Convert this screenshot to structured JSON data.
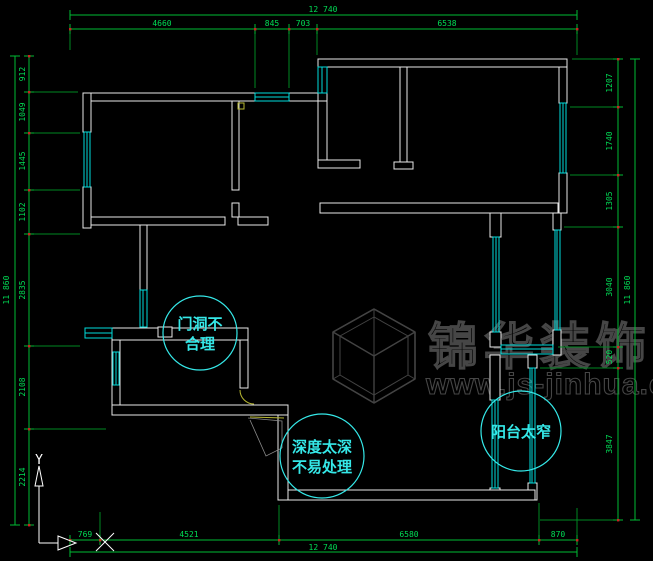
{
  "drawing_type": "apartment floor plan (CAD)",
  "colors": {
    "background": "#000000",
    "dimension_lines": "#00bb33",
    "dimension_text": "#00dd55",
    "walls": "#e9e9e9",
    "windows": "#00dcdc",
    "annotation": "#35e8e8",
    "watermark": "#474747",
    "tick_marker": "#cc2222",
    "door_symbol": "#b8b832"
  },
  "dimensions": {
    "top": {
      "total": "12 740",
      "segments": [
        "4660",
        "845",
        "703",
        "6538"
      ]
    },
    "bottom": {
      "total": "12 740",
      "segments": [
        "769",
        "4521",
        "6580",
        "870"
      ]
    },
    "left": {
      "total": "11 860",
      "segments": [
        "912",
        "1049",
        "1445",
        "1102",
        "2835",
        "2108",
        "2214"
      ]
    },
    "right": {
      "total": "11 860",
      "segments": [
        "1207",
        "1740",
        "1305",
        "3040",
        "520",
        "3847"
      ]
    }
  },
  "annotations": [
    {
      "id": "door-opening-issue",
      "lines": [
        "门洞不",
        "合理"
      ]
    },
    {
      "id": "depth-issue",
      "lines": [
        "深度太深",
        "不易处理"
      ]
    },
    {
      "id": "balcony-issue",
      "lines": [
        "阳台太窄"
      ]
    }
  ],
  "watermark": {
    "brand": "锦华装饰",
    "url": "www.js-jinhua.com"
  },
  "axis": {
    "x_label": "X",
    "y_label": "Y"
  }
}
